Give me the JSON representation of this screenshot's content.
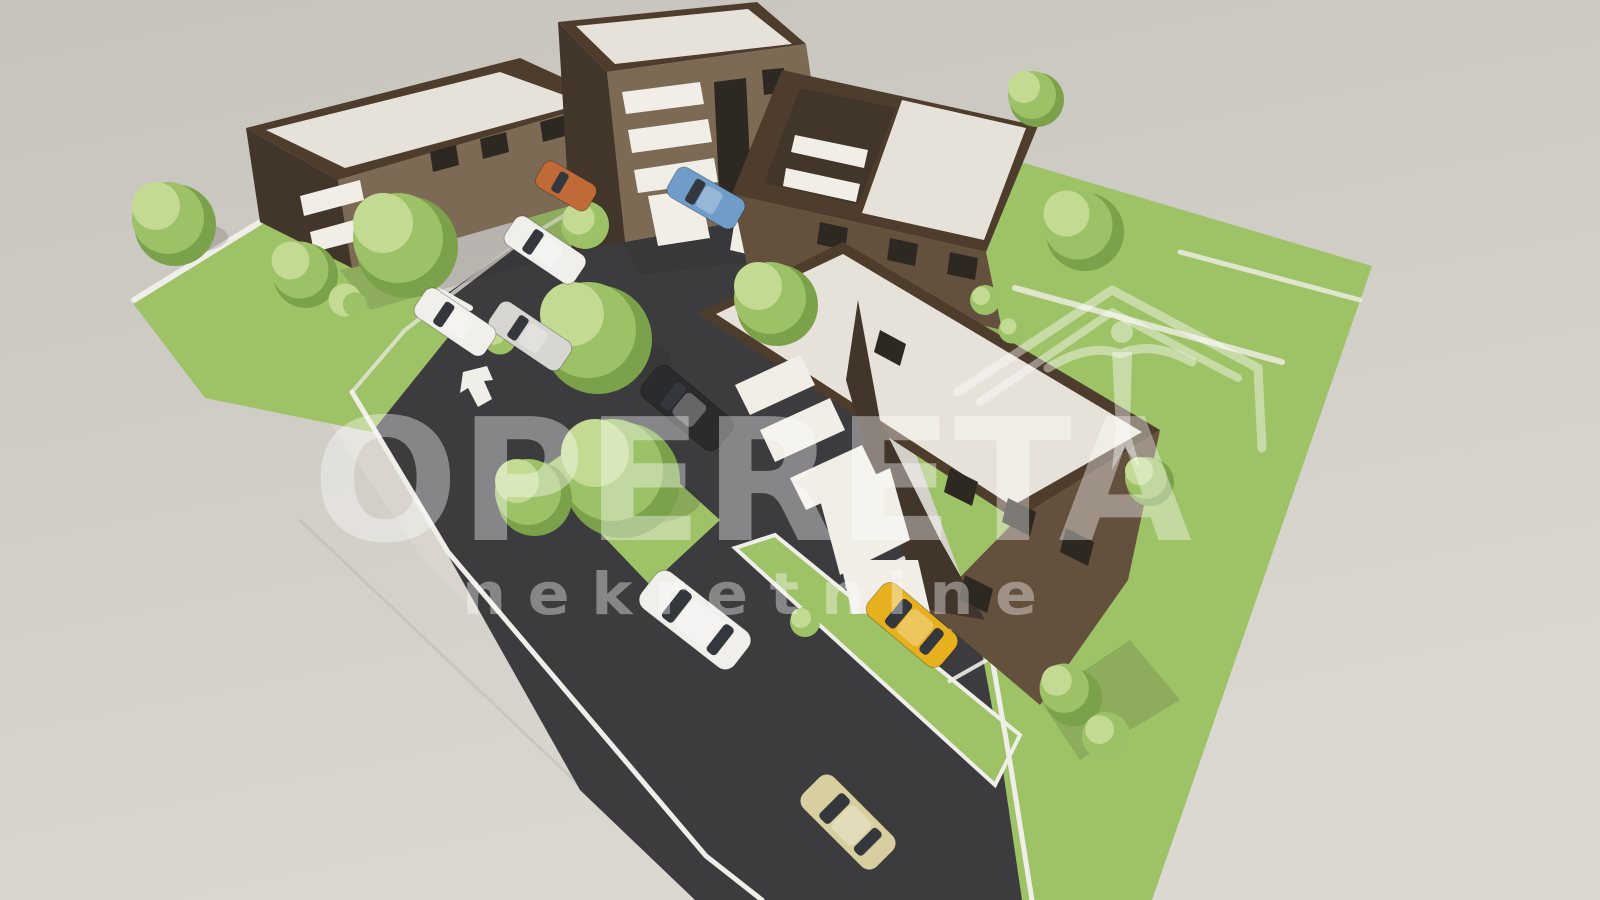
{
  "watermark": {
    "brand": "OPERETA",
    "subtitle": "n e k r e t n i n e",
    "logo": "house-roof-with-swallow"
  },
  "palette": {
    "bg-top": "#c6c2bc",
    "bg-bottom": "#dbd7d1",
    "asphalt": "#3c3c3f",
    "sidewalk": "#d9d5ce",
    "curb": "#f0eee9",
    "grass": "#9ec266",
    "grass-dark": "#84ab4e",
    "roof-cream": "#e7e2d9",
    "parapet": "#4e3d2c",
    "brick-light": "#7d6a55",
    "brick-mid": "#63503d",
    "brick-dark": "#42352a",
    "white-trim": "#f1eee8",
    "trim-shadow": "#d5d1c9",
    "window": "#2d2922",
    "tree-light": "#c3da92",
    "tree-mid": "#9cc167",
    "tree-dark": "#7ba24a",
    "car-white": "#f0efec",
    "car-yellow": "#e6b01f",
    "car-beige": "#d8cfa0",
    "car-dark": "#2b2b2d",
    "car-blue": "#6f9cc9",
    "car-orange": "#c06a38",
    "glass": "#34383d",
    "wm": "#ffffff"
  },
  "scene": {
    "type": "architectural-3d-render",
    "buildings": [
      {
        "id": "building-top-left",
        "stories": 3,
        "facade": "dark-brick",
        "roof": "flat-cream"
      },
      {
        "id": "building-top-mid",
        "stories": 3,
        "facade": "dark-brick",
        "roof": "flat-cream"
      },
      {
        "id": "building-top-right",
        "stories": 3,
        "facade": "dark-brick",
        "roof": "flat-cream"
      },
      {
        "id": "building-center",
        "stories": 3,
        "facade": "dark-brick",
        "roof": "flat-cream"
      }
    ],
    "vehicles": [
      {
        "id": "white-sedan-street",
        "color": "white"
      },
      {
        "id": "yellow-hatchback-driveway",
        "color": "yellow"
      },
      {
        "id": "beige-car-road",
        "color": "beige"
      },
      {
        "id": "dark-car-courtyard",
        "color": "dark"
      },
      {
        "id": "blue-car-parking",
        "color": "blue"
      },
      {
        "id": "white-car-parking-1",
        "color": "white"
      },
      {
        "id": "gray-car-parking",
        "color": "gray"
      },
      {
        "id": "white-car-parking-2",
        "color": "white"
      },
      {
        "id": "orange-car-parking",
        "color": "orange"
      }
    ],
    "road_marking": "turn-arrow"
  }
}
